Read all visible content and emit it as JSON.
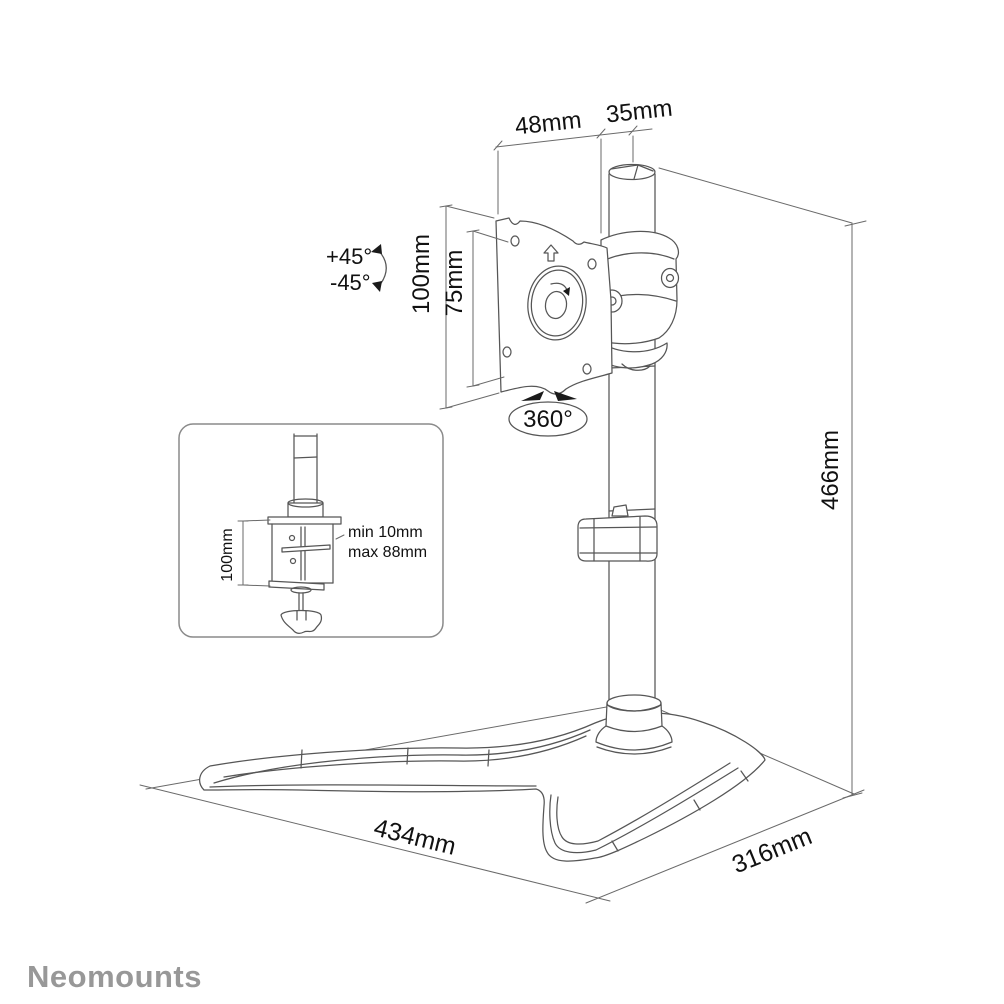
{
  "canvas": {
    "width": 1004,
    "height": 1004,
    "background": "#ffffff"
  },
  "colors": {
    "line": "#565656",
    "dimension_line": "#6a6a6a",
    "text": "#111111",
    "logo": "#989898"
  },
  "labels": {
    "top_width_outer": "48mm",
    "top_width_pole": "35mm",
    "tilt_up": "+45°",
    "tilt_down": "-45°",
    "vesa_outer": "100mm",
    "vesa_inner": "75mm",
    "rotation": "360°",
    "height": "466mm",
    "base_width": "434mm",
    "base_depth": "316mm"
  },
  "inset": {
    "clamp_height": "100mm",
    "clamp_min": "min 10mm",
    "clamp_max": "max 88mm"
  },
  "brand": {
    "logo_text": "Neomounts"
  }
}
